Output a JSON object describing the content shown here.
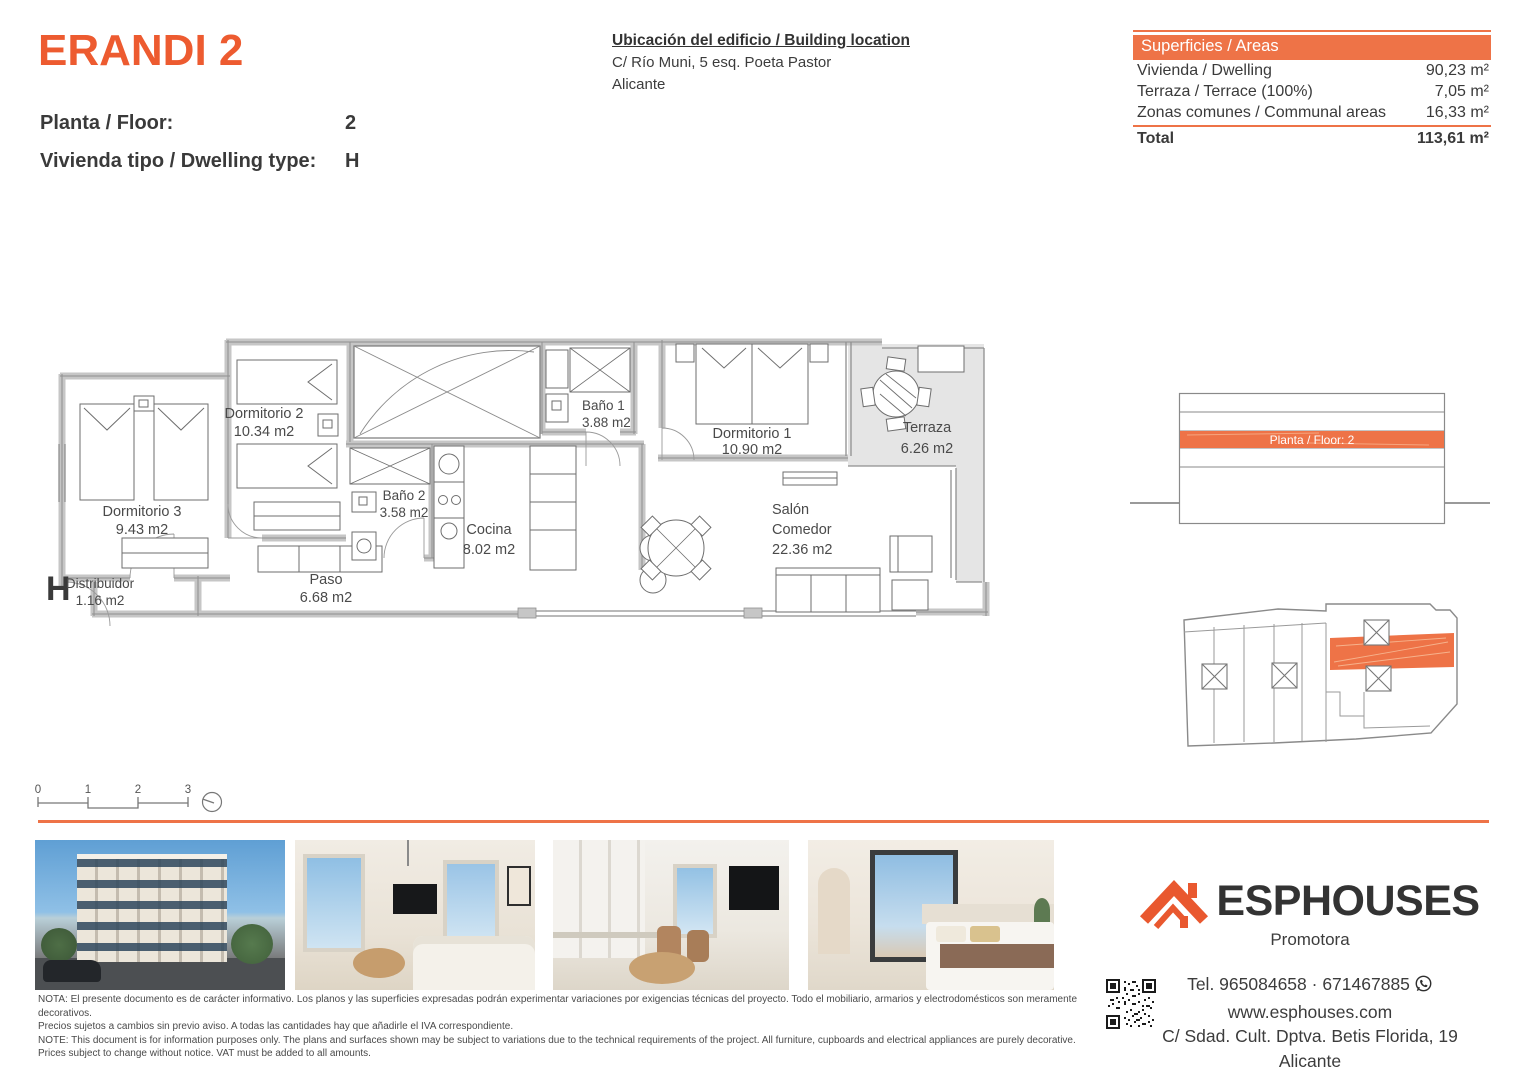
{
  "colors": {
    "accent": "#EE7347",
    "title_orange": "#ED5B30",
    "logo_orange": "#E9582F"
  },
  "header": {
    "project_title": "ERANDI 2",
    "floor_label": "Planta / Floor:",
    "floor_value": "2",
    "dwelling_label": "Vivienda tipo / Dwelling type:",
    "dwelling_value": "H",
    "location": {
      "title": "Ubicación del edificio / Building location",
      "address": "C/ Río Muni, 5 esq. Poeta Pastor",
      "city": "Alicante"
    }
  },
  "areas": {
    "header": "Superficies / Areas",
    "rows": [
      {
        "label": "Vivienda / Dwelling",
        "value": "90,23 m²"
      },
      {
        "label": "Terraza / Terrace (100%)",
        "value": "7,05 m²"
      },
      {
        "label": "Zonas comunes / Communal areas",
        "value": "16,33 m²"
      }
    ],
    "total": {
      "label": "Total",
      "value": "113,61 m²"
    }
  },
  "plan": {
    "unit_letter": "H",
    "rooms": {
      "dormitorio3": {
        "name": "Dormitorio 3",
        "area": "9.43 m2"
      },
      "dormitorio2": {
        "name": "Dormitorio 2",
        "area": "10.34 m2"
      },
      "distribuidor": {
        "name": "Distribuidor",
        "area": "1.16 m2"
      },
      "paso": {
        "name": "Paso",
        "area": "6.68 m2"
      },
      "bano2": {
        "name": "Baño 2",
        "area": "3.58 m2"
      },
      "cocina": {
        "name": "Cocina",
        "area": "8.02 m2"
      },
      "bano1": {
        "name": "Baño 1",
        "area": "3.88 m2"
      },
      "dormitorio1": {
        "name": "Dormitorio 1",
        "area": "10.90 m2"
      },
      "salon": {
        "name": "Salón",
        "name2": "Comedor",
        "area": "22.36 m2"
      },
      "terraza": {
        "name": "Terraza",
        "area": "6.26 m2"
      }
    },
    "scale": {
      "t0": "0",
      "t1": "1",
      "t2": "2",
      "t3": "3"
    }
  },
  "key_diagrams": {
    "section_highlight": "Planta / Floor: 2"
  },
  "footer": {
    "notes": [
      "NOTA: El presente documento es de carácter informativo. Los planos y las superficies expresadas podrán experimentar variaciones por exigencias técnicas del proyecto. Todo el mobiliario, armarios y electrodomésticos son meramente decorativos.",
      "Precios sujetos a cambios sin previo aviso. A todas las cantidades hay que añadirle el IVA correspondiente.",
      "NOTE: This document is for information purposes only. The plans and surfaces shown may be subject to variations due to the technical requirements of the project. All furniture, cupboards and electrical appliances are purely decorative.",
      "Prices subject to change without notice. VAT must be added to all amounts."
    ],
    "brand": {
      "name": "ESPHOUSES",
      "subtitle": "Promotora",
      "phone": "Tel. 965084658 · 671467885",
      "website": "www.esphouses.com",
      "address": "C/ Sdad. Cult. Dptva. Betis Florida, 19",
      "city": "Alicante"
    }
  }
}
